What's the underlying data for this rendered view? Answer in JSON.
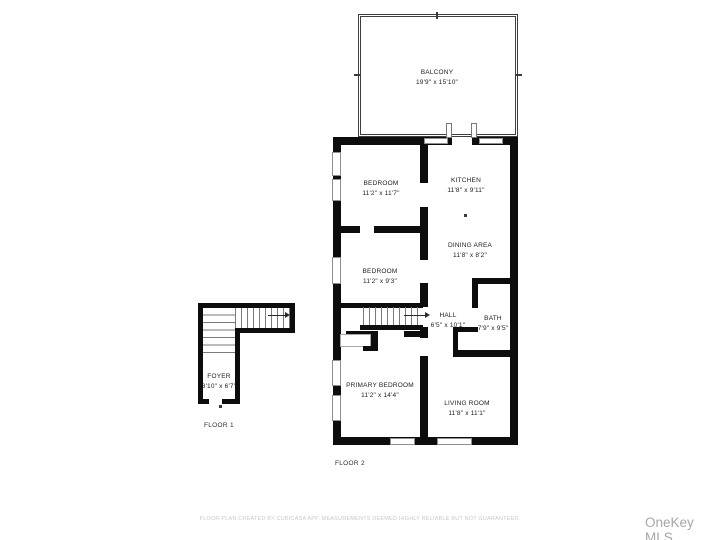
{
  "page": {
    "disclaimer": "FLOOR PLAN CREATED BY CUBICASA APP. MEASUREMENTS DEEMED HIGHLY RELIABLE BUT NOT GUARANTEED.",
    "watermark": "OneKey MLS"
  },
  "floors": {
    "floor1_label": "FLOOR 1",
    "floor2_label": "FLOOR 2"
  },
  "rooms": {
    "balcony": {
      "name": "BALCONY",
      "dims": "19'9\" x 15'10\""
    },
    "bedroom_top": {
      "name": "BEDROOM",
      "dims": "11'2\" x 11'7\""
    },
    "kitchen": {
      "name": "KITCHEN",
      "dims": "11'8\" x 9'11\""
    },
    "bedroom_mid": {
      "name": "BEDROOM",
      "dims": "11'2\" x 9'3\""
    },
    "dining": {
      "name": "DINING AREA",
      "dims": "11'8\" x 8'2\""
    },
    "hall": {
      "name": "HALL",
      "dims": "6'5\" x 10'1\""
    },
    "bath": {
      "name": "BATH",
      "dims": "7'9\" x 9'5\""
    },
    "primary": {
      "name": "PRIMARY BEDROOM",
      "dims": "11'2\" x 14'4\""
    },
    "living": {
      "name": "LIVING ROOM",
      "dims": "11'8\" x 11'1\""
    },
    "foyer": {
      "name": "FOYER",
      "dims": "3'10\" x 6'7\""
    }
  },
  "colors": {
    "wall": "#0d0d0d",
    "window_outline": "#8f8f8f",
    "label_text": "#1c1c1c",
    "disclaimer_text": "#c6c9cb",
    "watermark_text": "#a4a7a9"
  }
}
